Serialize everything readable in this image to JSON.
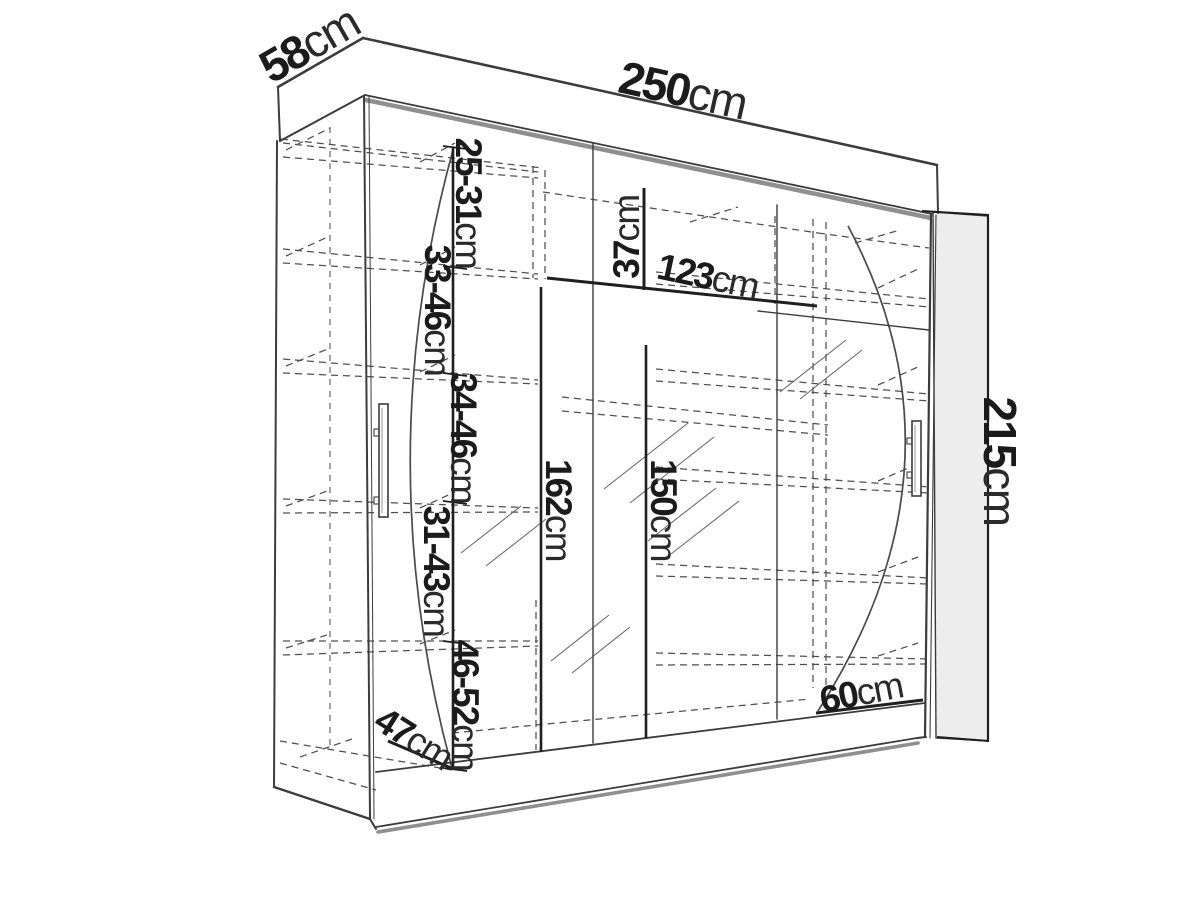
{
  "figure": {
    "kind": "wardrobe-dimension-diagram",
    "style": "technical line drawing, perspective view, white background"
  },
  "colors": {
    "line": "#3c3c3c",
    "soft_line": "#8f8f8f",
    "dash_line": "#4f4f4f",
    "dim_line": "#1f1f1f",
    "panel_fill": "#ededed",
    "text": "#1b1b1b",
    "background": "#ffffff"
  },
  "labels": {
    "depth": {
      "num": "58",
      "unit": "cm"
    },
    "width": {
      "num": "250",
      "unit": "cm"
    },
    "height": {
      "num": "215",
      "unit": "cm"
    },
    "gap_a": {
      "num": "25-31",
      "unit": "cm"
    },
    "gap_b": {
      "num": "33-46",
      "unit": "cm"
    },
    "gap_c": {
      "num": "34-46",
      "unit": "cm"
    },
    "gap_d": {
      "num": "31-43",
      "unit": "cm"
    },
    "gap_e": {
      "num": "46-52",
      "unit": "cm"
    },
    "top_compartment": {
      "num": "37",
      "unit": "cm"
    },
    "upper_shelf_span": {
      "num": "123",
      "unit": "cm"
    },
    "left_interior_height": {
      "num": "162",
      "unit": "cm"
    },
    "right_interior_height": {
      "num": "150",
      "unit": "cm"
    },
    "bottom_span": {
      "num": "60",
      "unit": "cm"
    },
    "floor_depth": {
      "num": "47",
      "unit": "cm"
    }
  }
}
